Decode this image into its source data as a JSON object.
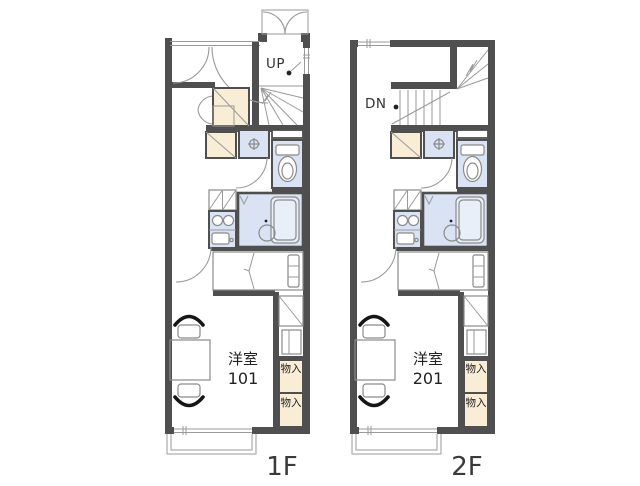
{
  "plan_type": "apartment-floorplan",
  "floors": [
    {
      "label": "1F",
      "stair_label": "UP",
      "room": {
        "name": "洋室",
        "number": "101"
      },
      "storage_labels": [
        "物入",
        "物入"
      ]
    },
    {
      "label": "2F",
      "stair_label": "DN",
      "room": {
        "name": "洋室",
        "number": "201"
      },
      "storage_labels": [
        "物入",
        "物入"
      ]
    }
  ],
  "icons": {
    "washing_machine": "circle-with-cross",
    "toilet": "tank-and-bowl",
    "bathtub": "rounded-rectangle",
    "stove": "two-burner-circles",
    "sink": "basin-with-faucet-dot",
    "refrigerator": "crossed-box",
    "closet": "diagonal-box",
    "door": "quarter-circle-arc",
    "bifold-door": "double-leaf-arcs",
    "stairs": "tread-lines"
  },
  "colors": {
    "wall": "#4f4f4f",
    "closet": "#f9edd6",
    "wet": "#d9e3f4",
    "line": "#8a8a8a",
    "text": "#2e2e2e"
  }
}
